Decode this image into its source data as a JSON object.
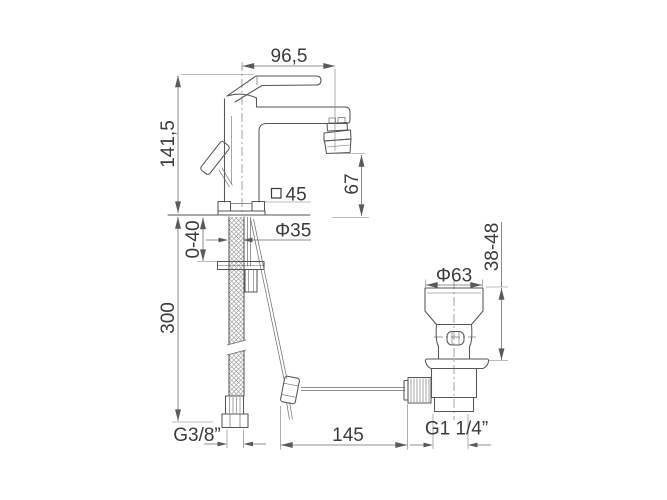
{
  "drawing": {
    "background_color": "#ffffff",
    "line_color": "#565656",
    "text_color": "#3b3b3b"
  },
  "dimensions": {
    "spout_reach": "96,5",
    "body_height": "141,5",
    "outlet_height": "67",
    "base_square": "45",
    "shank_diameter": "Φ35",
    "mounting_range": "0-40",
    "hose_length": "300",
    "waste_cap_diameter": "Φ63",
    "waste_height_range": "38-48",
    "rod_length": "145",
    "inlet_thread": "G3/8”",
    "waste_thread": "G1 1/4”"
  }
}
